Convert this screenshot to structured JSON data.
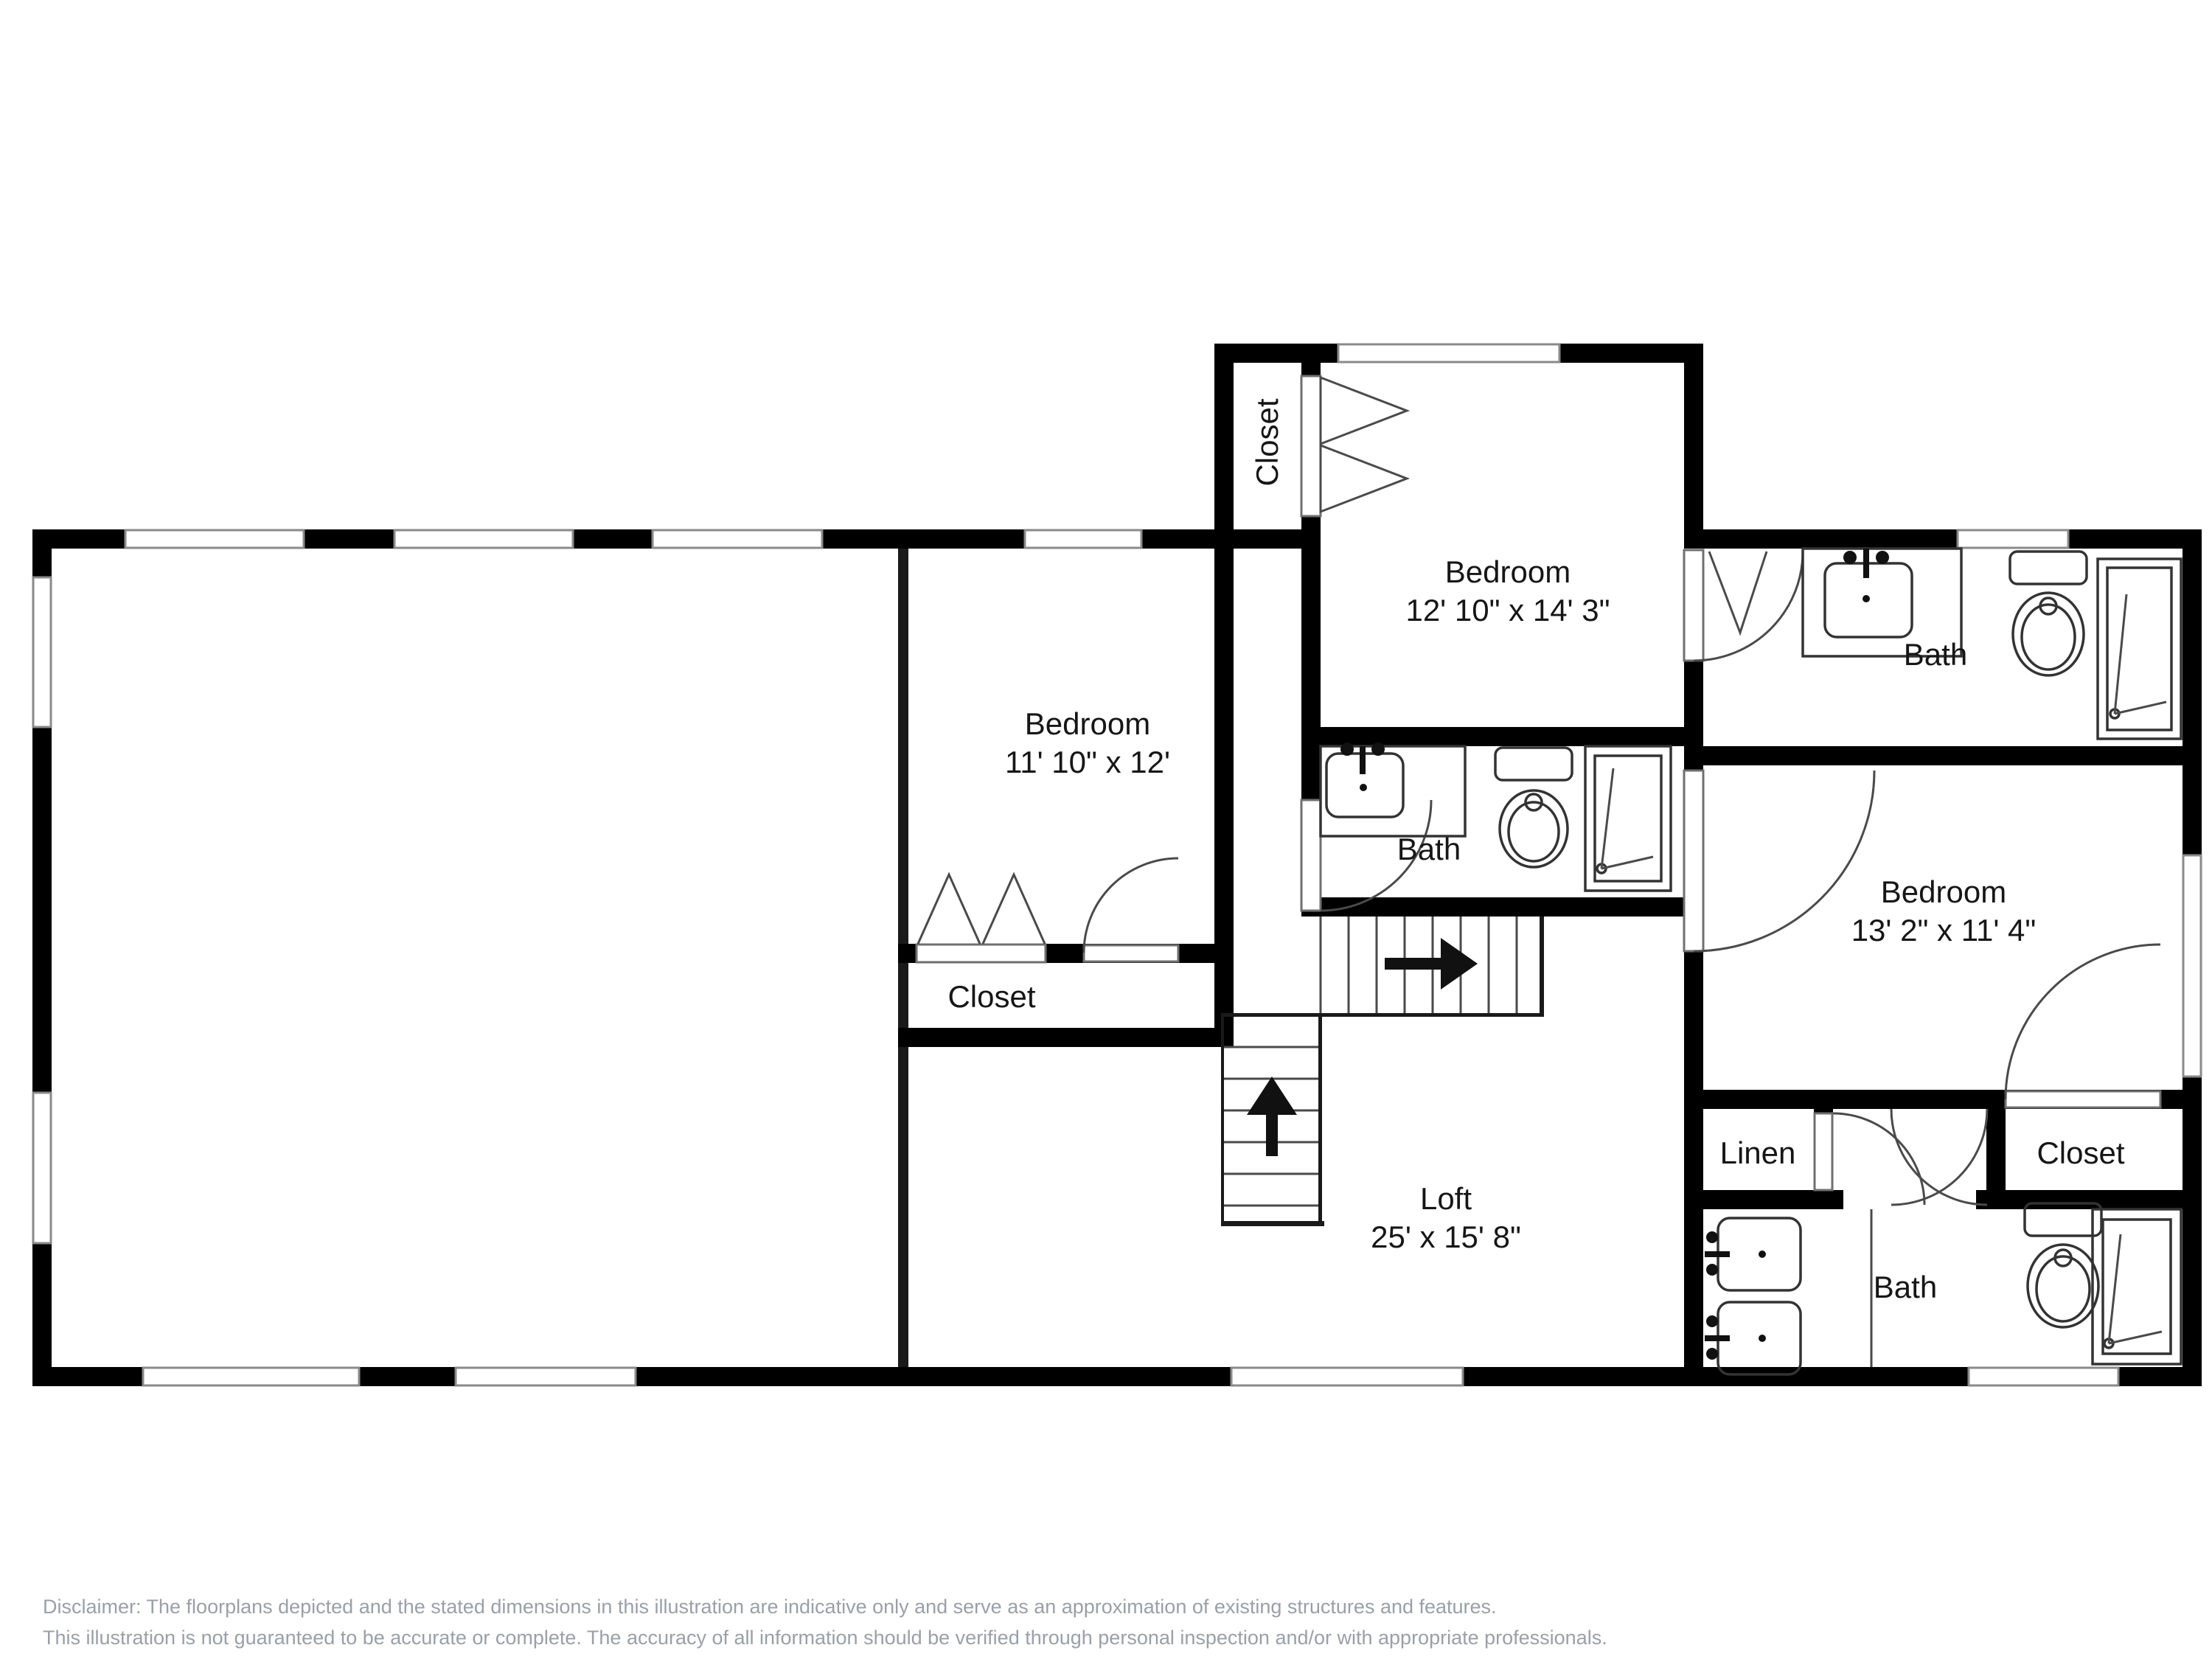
{
  "rooms": {
    "bedroom_top": {
      "name": "Bedroom",
      "dims": "12' 10\" x 14' 3\""
    },
    "bedroom_left": {
      "name": "Bedroom",
      "dims": "11' 10\" x 12'"
    },
    "bedroom_right": {
      "name": "Bedroom",
      "dims": "13' 2\" x 11' 4\""
    },
    "loft": {
      "name": "Loft",
      "dims": "25' x 15' 8\""
    },
    "bath_top_right": {
      "name": "Bath"
    },
    "bath_middle": {
      "name": "Bath"
    },
    "bath_bottom_right": {
      "name": "Bath"
    },
    "closet_top": {
      "name": "Closet"
    },
    "closet_lower_left": {
      "name": "Closet"
    },
    "closet_right": {
      "name": "Closet"
    },
    "linen": {
      "name": "Linen"
    }
  },
  "disclaimer": {
    "line1": "Disclaimer: The floorplans depicted and the stated dimensions in this illustration are indicative only and serve as an approximation of existing structures and features.",
    "line2": "This illustration is not guaranteed to be accurate or complete. The accuracy of all information should be verified through personal inspection and/or with appropriate professionals."
  },
  "colors": {
    "wall": "#000000",
    "label": "#161616",
    "disclaimer": "#9aa0a8",
    "window_stroke": "#8a8a8a"
  }
}
